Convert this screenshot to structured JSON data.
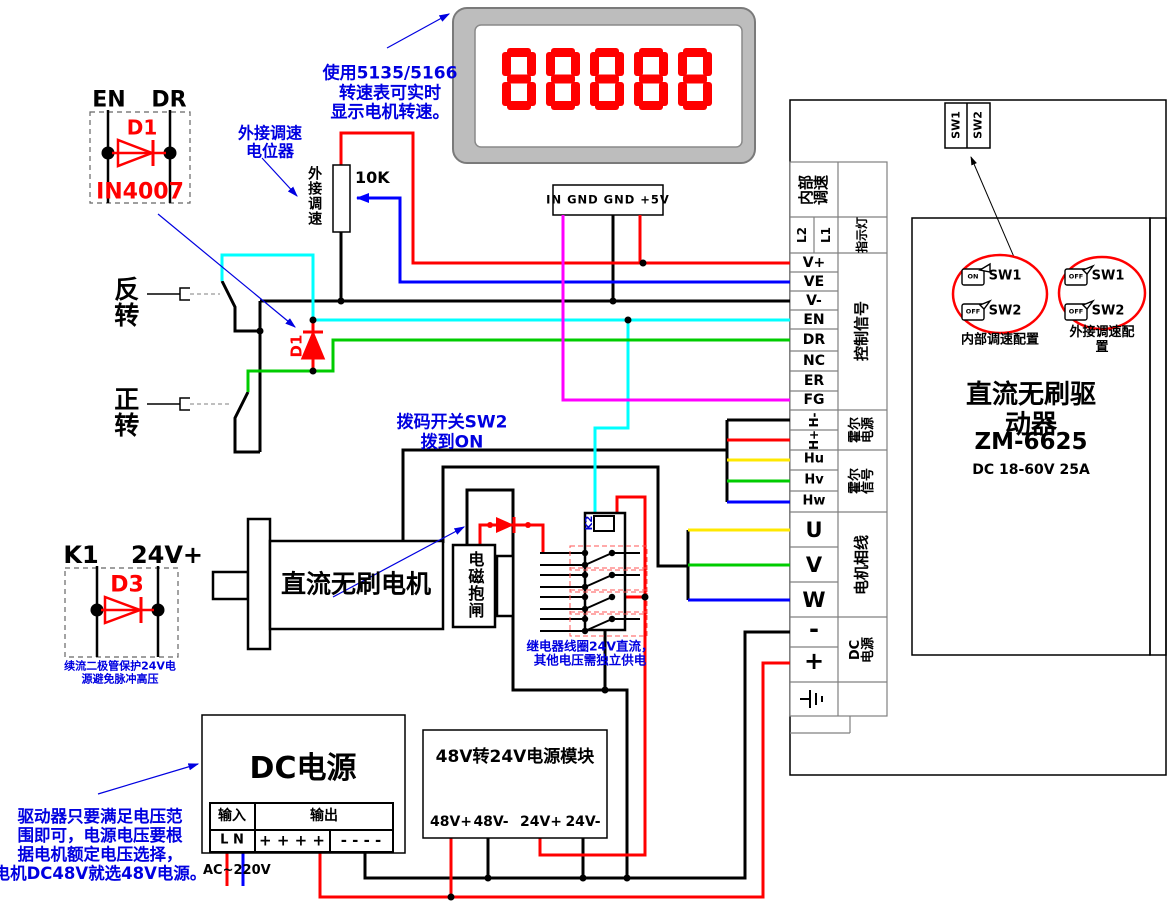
{
  "colors": {
    "wire_red": "#ff0000",
    "wire_blue": "#0000ff",
    "wire_green": "#00cc00",
    "wire_cyan": "#00ffff",
    "wire_magenta": "#ff00ff",
    "wire_yellow": "#ffe800",
    "wire_black": "#000000",
    "annotation_blue": "#0000e0",
    "component_red": "#ff0000",
    "display_bezel": "#bdbdbd"
  },
  "annotations": {
    "tachometer_note": "使用5135/5166\n转速表可实时\n显示电机转速。",
    "pot_note": "外接调速\n电位器",
    "dip_note": "拨码开关SW2\n拨到ON",
    "d3_note": "续流二极管保护24V电\n源避免脉冲高压",
    "relay_note": "继电器线圈24V直流，\n其他电压需独立供电",
    "psu_note": "驱动器只要满足电压范\n围即可，电源电压要根\n据电机额定电压选择，\n电机DC48V就选48V电源。"
  },
  "d1_block": {
    "pin_left": "EN",
    "pin_right": "DR",
    "label": "D1",
    "part": "IN4007"
  },
  "d1_circuit_label": "D1",
  "d3_block": {
    "pin_left": "K1",
    "pin_right": "24V+",
    "label": "D3"
  },
  "pot": {
    "value": "10K",
    "label": "外接调速"
  },
  "switches": {
    "reverse": "反转",
    "forward": "正转"
  },
  "meter": {
    "display": "88888",
    "connector": "IN GND GND +5V"
  },
  "motor": {
    "label": "直流无刷电机",
    "brake": "电磁抱闸"
  },
  "relay": {
    "label": "K2"
  },
  "driver": {
    "title": "直流无刷驱动器",
    "model": "ZM-6625",
    "rating": "DC 18-60V 25A",
    "sw1": "SW1",
    "sw2": "SW2",
    "dip_internal_caption": "内部调速配置",
    "dip_external_caption": "外接调速配置",
    "dip_internal": [
      {
        "state": "ON",
        "label": "SW1"
      },
      {
        "state": "OFF",
        "label": "SW2"
      }
    ],
    "dip_external": [
      {
        "state": "OFF",
        "label": "SW1"
      },
      {
        "state": "OFF",
        "label": "SW2"
      }
    ]
  },
  "terminals": {
    "internal_speed": "内部\n调速",
    "l2": "L2",
    "l1": "L1",
    "indicator": "指示灯",
    "v_plus": "V+",
    "ve": "VE",
    "v_minus": "V-",
    "en": "EN",
    "dr": "DR",
    "nc": "NC",
    "er": "ER",
    "fg": "FG",
    "h_minus": "H-",
    "h_plus": "H+",
    "hu": "Hu",
    "hv": "Hv",
    "hw": "Hw",
    "u": "U",
    "v": "V",
    "w": "W",
    "minus": "-",
    "plus": "+"
  },
  "groups": {
    "control": "控制信号",
    "hall_power": "霍尔\n电源",
    "hall_signal": "霍尔\n信号",
    "phase": "电机相线",
    "dc_power": "DC\n电源"
  },
  "dc_supply": {
    "title": "DC电源",
    "input": "输入",
    "output": "输出",
    "input_pins": "L N",
    "plus_pins": "+ + + +",
    "minus_pins": "- - - -",
    "ac": "AC~220V"
  },
  "module": {
    "title": "48V转24V电源模块",
    "p1": "48V+",
    "p2": "48V-",
    "p3": "24V+",
    "p4": "24V-"
  }
}
